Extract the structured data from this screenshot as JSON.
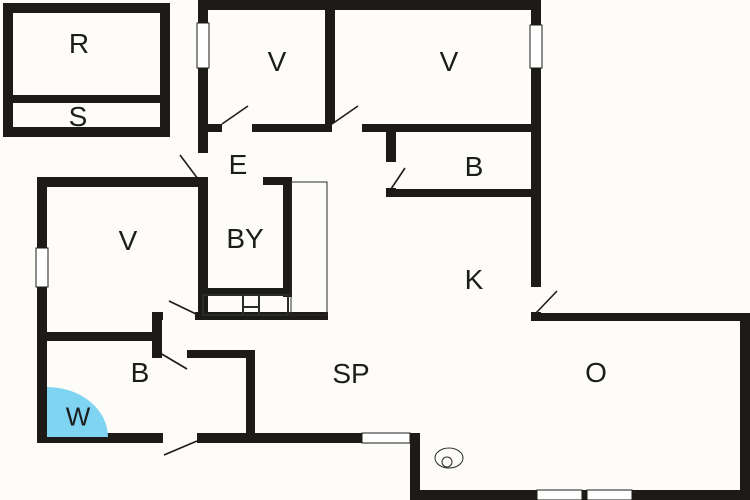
{
  "plan": {
    "canvas": {
      "width": 750,
      "height": 500
    },
    "colors": {
      "background": "#fdfcf8",
      "wall": "#1d1b17",
      "thin_line": "#2b2b2b",
      "window_fill": "#ffffff",
      "shower": "#7fd4f2",
      "label": "#1c1c1c"
    },
    "rooms": [
      {
        "id": "r",
        "label": "R",
        "x": 79,
        "y": 43,
        "size": 28
      },
      {
        "id": "s",
        "label": "S",
        "x": 78,
        "y": 116,
        "size": 28
      },
      {
        "id": "v-top-left",
        "label": "V",
        "x": 277,
        "y": 61,
        "size": 28
      },
      {
        "id": "v-top-right",
        "label": "V",
        "x": 449,
        "y": 61,
        "size": 28
      },
      {
        "id": "b-top-right",
        "label": "B",
        "x": 474,
        "y": 166,
        "size": 28
      },
      {
        "id": "e",
        "label": "E",
        "x": 238,
        "y": 164,
        "size": 28
      },
      {
        "id": "by",
        "label": "BY",
        "x": 245,
        "y": 238,
        "size": 28
      },
      {
        "id": "v-left",
        "label": "V",
        "x": 128,
        "y": 240,
        "size": 28
      },
      {
        "id": "k",
        "label": "K",
        "x": 474,
        "y": 279,
        "size": 28
      },
      {
        "id": "b-left",
        "label": "B",
        "x": 140,
        "y": 372,
        "size": 28
      },
      {
        "id": "w",
        "label": "W",
        "x": 78,
        "y": 416,
        "size": 26
      },
      {
        "id": "sp",
        "label": "SP",
        "x": 351,
        "y": 373,
        "size": 28
      },
      {
        "id": "o",
        "label": "O",
        "x": 596,
        "y": 372,
        "size": 28
      }
    ],
    "walls": [
      [
        3,
        3,
        167,
        10
      ],
      [
        3,
        3,
        10,
        134
      ],
      [
        160,
        3,
        10,
        134
      ],
      [
        3,
        127,
        167,
        10
      ],
      [
        13,
        95,
        147,
        8
      ],
      [
        198,
        0,
        343,
        10
      ],
      [
        198,
        0,
        10,
        318
      ],
      [
        531,
        0,
        10,
        313
      ],
      [
        325,
        10,
        10,
        117
      ],
      [
        198,
        124,
        343,
        8
      ],
      [
        386,
        124,
        10,
        73
      ],
      [
        386,
        189,
        155,
        8
      ],
      [
        263,
        177,
        27,
        8
      ],
      [
        283,
        177,
        9,
        120
      ],
      [
        203,
        288,
        88,
        8
      ],
      [
        152,
        312,
        176,
        8
      ],
      [
        152,
        312,
        10,
        46
      ],
      [
        152,
        350,
        103,
        8
      ],
      [
        246,
        350,
        9,
        91
      ],
      [
        37,
        177,
        161,
        10
      ],
      [
        37,
        177,
        10,
        266
      ],
      [
        37,
        433,
        383,
        10
      ],
      [
        37,
        332,
        115,
        9
      ],
      [
        531,
        313,
        219,
        8
      ],
      [
        740,
        313,
        10,
        187
      ],
      [
        410,
        490,
        340,
        10
      ],
      [
        410,
        433,
        10,
        62
      ]
    ],
    "windows": [
      [
        197,
        23,
        12,
        45
      ],
      [
        530,
        25,
        12,
        43
      ],
      [
        36,
        248,
        12,
        39
      ],
      [
        362,
        433,
        48,
        10
      ],
      [
        537,
        490,
        45,
        10
      ],
      [
        587,
        490,
        45,
        10
      ]
    ],
    "door_openings": [
      [
        222,
        123,
        30,
        10
      ],
      [
        332,
        123,
        30,
        10
      ],
      [
        385,
        162,
        12,
        26
      ],
      [
        197,
        153,
        12,
        24
      ],
      [
        530,
        287,
        12,
        25
      ],
      [
        163,
        311,
        32,
        10
      ],
      [
        162,
        349,
        25,
        10
      ],
      [
        163,
        432,
        34,
        12
      ]
    ],
    "door_swings": [
      [
        222,
        124,
        248,
        106
      ],
      [
        332,
        124,
        358,
        106
      ],
      [
        391,
        189,
        405,
        168
      ],
      [
        198,
        179,
        180,
        155
      ],
      [
        536,
        313,
        557,
        291
      ],
      [
        196,
        314,
        169,
        301
      ],
      [
        160,
        353,
        187,
        369
      ],
      [
        197,
        441,
        164,
        455
      ]
    ],
    "fixtures": {
      "closet": [
        291,
        182,
        36,
        133
      ],
      "bath_unit_rect": [
        203,
        295,
        85,
        20
      ],
      "bath_unit_lines": [
        [
          243,
          295,
          243,
          315
        ],
        [
          259,
          295,
          259,
          315
        ],
        [
          243,
          307,
          259,
          307
        ]
      ],
      "floor_drain": {
        "cx": 449,
        "cy": 458,
        "rx": 14,
        "ry": 10,
        "inner_cx": 447,
        "inner_cy": 462,
        "inner_r": 5
      },
      "shower_corner": {
        "x": 47,
        "y": 437,
        "rx": 61,
        "ry": 50
      }
    }
  }
}
